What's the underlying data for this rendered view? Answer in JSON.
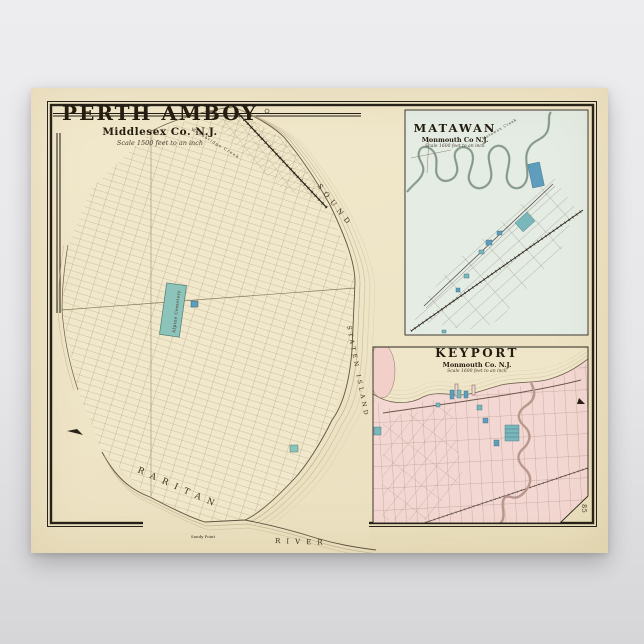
{
  "poster": {
    "main_map": {
      "title": "PERTH AMBOY",
      "subtitle": "Middlesex Co. N.J.",
      "scale_note": "Scale 1500 feet to an inch",
      "labels": {
        "woodbridge_creek": "Woodbridge Creek",
        "sound": "SOUND",
        "staten_island": "STATEN ISLAND",
        "raritan": "RARITAN",
        "river": "RIVER",
        "sandy_point": "Sandy Point",
        "alpine_cemetery": "Alpine Cemetery"
      }
    },
    "matawan": {
      "title": "MATAWAN",
      "subtitle": "Monmouth Co N.J.",
      "scale_note": "Scale 1600 feet to an inch",
      "labels": {
        "creek": "Matawan Creek"
      }
    },
    "keyport": {
      "title": "KEYPORT",
      "subtitle": "Monmouth Co. N.J.",
      "scale_note": "Scale 1600 feet to an inch"
    },
    "page_number": "85",
    "colors": {
      "paper": "#efe5c6",
      "ink": "#2b241b",
      "grid_line": "#9c8f74",
      "teal_block": "#8cc3bb",
      "blue_block": "#5e9dbb",
      "matawan_bg": "#e4ece4",
      "keyport_bg": "#f3d7d2",
      "keyport_creek": "#b9988e",
      "water_hatch": "#cfc1a1"
    }
  }
}
